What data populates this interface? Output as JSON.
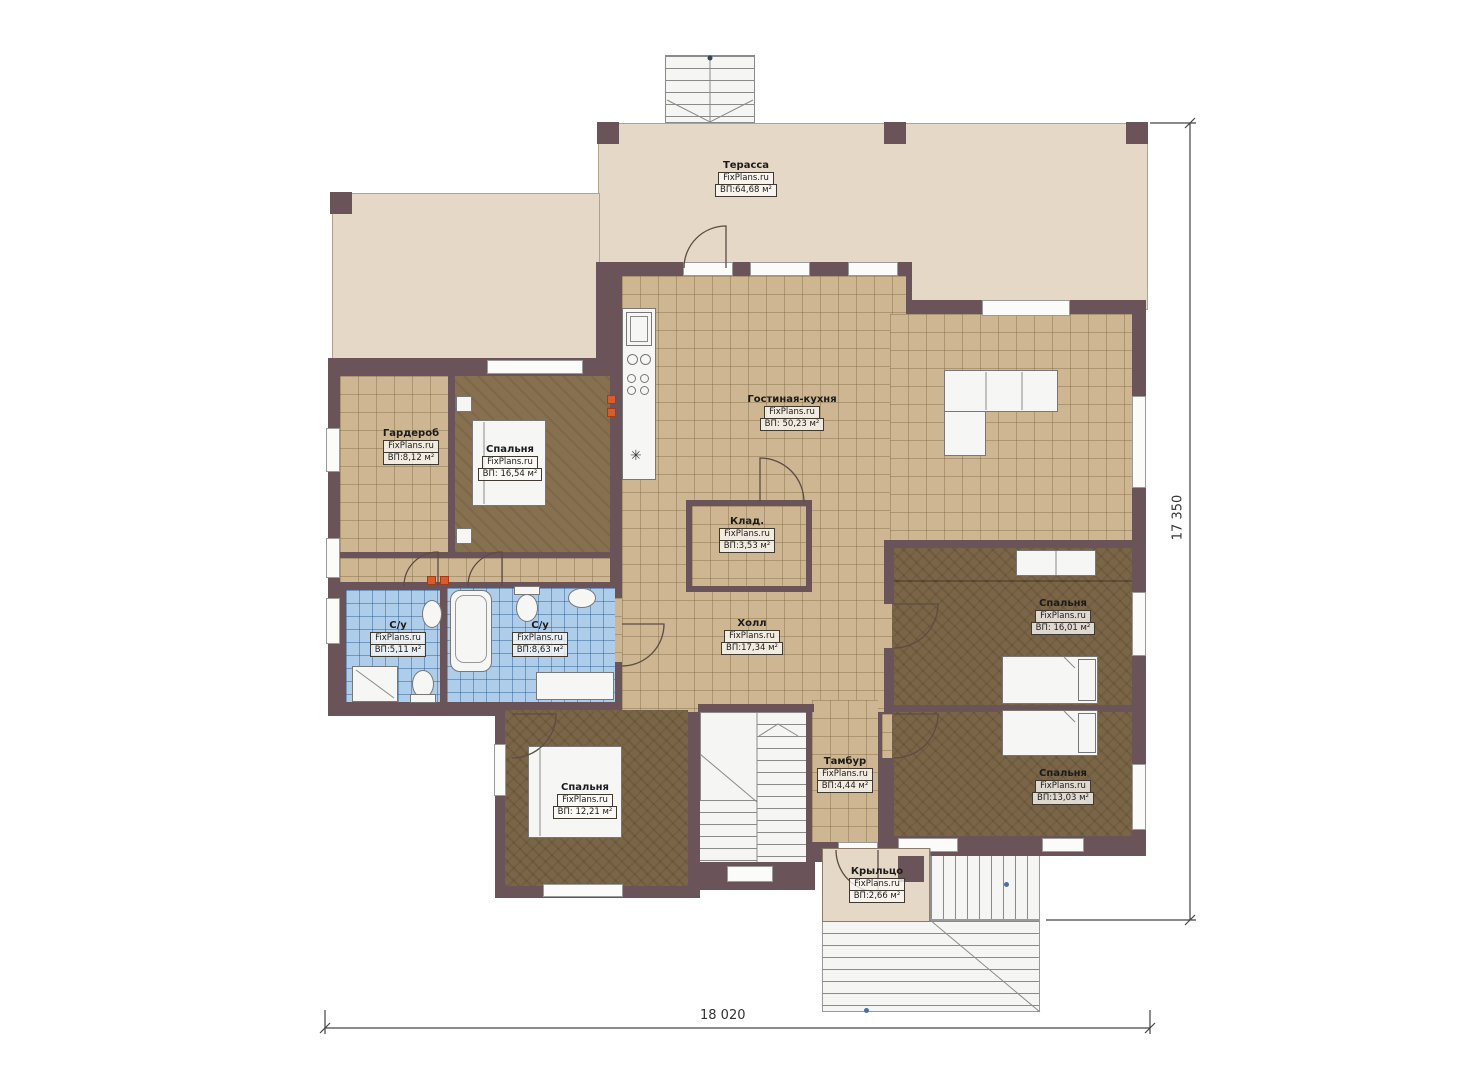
{
  "plan_title": "House first-floor plan",
  "rooms": [
    {
      "id": "terrace",
      "name": "Терасса",
      "site": "FixPlans.ru",
      "area": "ВП:64,68 м²"
    },
    {
      "id": "living-kitchen",
      "name": "Гостиная-кухня",
      "site": "FixPlans.ru",
      "area": "ВП: 50,23 м²"
    },
    {
      "id": "wardrobe",
      "name": "Гардероб",
      "site": "FixPlans.ru",
      "area": "ВП:8,12 м²"
    },
    {
      "id": "bedroom-1",
      "name": "Спальня",
      "site": "FixPlans.ru",
      "area": "ВП: 16,54 м²"
    },
    {
      "id": "storage",
      "name": "Клад.",
      "site": "FixPlans.ru",
      "area": "ВП:3,53 м²"
    },
    {
      "id": "bath-1",
      "name": "С/у",
      "site": "FixPlans.ru",
      "area": "ВП:5,11 м²"
    },
    {
      "id": "bath-2",
      "name": "С/у",
      "site": "FixPlans.ru",
      "area": "ВП:8,63 м²"
    },
    {
      "id": "hall",
      "name": "Холл",
      "site": "FixPlans.ru",
      "area": "ВП:17,34 м²"
    },
    {
      "id": "bedroom-2",
      "name": "Спальня",
      "site": "FixPlans.ru",
      "area": "ВП: 16,01 м²"
    },
    {
      "id": "bedroom-3",
      "name": "Спальня",
      "site": "FixPlans.ru",
      "area": "ВП:13,03 м²"
    },
    {
      "id": "bedroom-4",
      "name": "Спальня",
      "site": "FixPlans.ru",
      "area": "ВП: 12,21 м²"
    },
    {
      "id": "tambour",
      "name": "Тамбур",
      "site": "FixPlans.ru",
      "area": "ВП:4,44 м²"
    },
    {
      "id": "porch",
      "name": "Крыльцо",
      "site": "FixPlans.ru",
      "area": "ВП:2,66 м²"
    }
  ],
  "dimensions": {
    "width_label": "18 020",
    "height_label": "17 350"
  },
  "symbols": {
    "kitchen_drain": "✳"
  },
  "colors": {
    "wall": "#6b5459",
    "tile_floor": "#cdb691",
    "wood_floor": "#86704f",
    "wood_floor_dark": "#7b6547",
    "bath_tile": "#aecdea",
    "terrace_floor": "#e6d8c6",
    "radiator": "#d85c2c"
  }
}
